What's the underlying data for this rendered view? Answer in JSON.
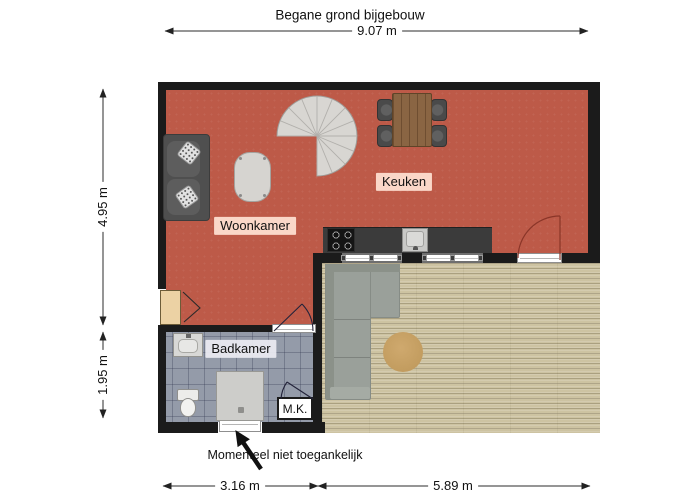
{
  "title": "Begane grond bijgebouw",
  "dimensions": {
    "top": "9.07 m",
    "left_upper": "4.95 m",
    "left_lower": "1.95 m",
    "bottom_left": "3.16 m",
    "bottom_right": "5.89 m"
  },
  "rooms": {
    "woonkamer": "Woonkamer",
    "keuken": "Keuken",
    "badkamer": "Badkamer",
    "meter_closet": "M.K."
  },
  "annotations": {
    "inaccessible_note": "Momenteel niet toegankelijk"
  },
  "furniture": {
    "living_room": [
      "sofa",
      "coffee-table",
      "spiral-staircase"
    ],
    "kitchen": [
      "dining-table",
      "four-chairs",
      "counter",
      "cooktop",
      "sink"
    ],
    "deck": [
      "sectional-sofa",
      "round-rug"
    ],
    "bathroom": [
      "washbasin",
      "toilet",
      "shower",
      "exterior-door"
    ]
  },
  "colors": {
    "wall": "#1b1b1b",
    "floor-living": "#bd5a48",
    "floor-deck": "#cdc3a2",
    "floor-bath": "#949ba9",
    "counter": "#3b3b3b",
    "stair": "#d8d6d2",
    "label-bg": "rgba(255,226,212,0.92)"
  }
}
